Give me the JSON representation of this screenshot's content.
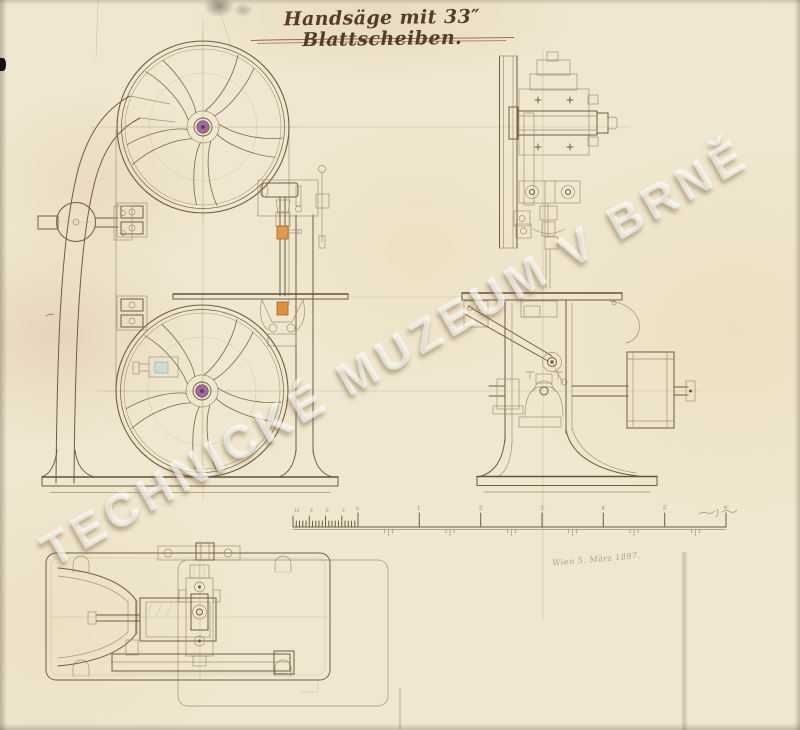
{
  "page": {
    "title": "Handsäge mit 33″ Blattscheiben.",
    "watermark": "TECHNICKÉ MUZEUM V BRNĚ",
    "date_note": "Wien 5. März 1897."
  },
  "scale_bar": {
    "zero_label": "0",
    "minor_labels": [
      "12",
      "9",
      "6",
      "3"
    ],
    "major_labels": [
      "1′",
      "2′",
      "3′",
      "4′",
      "5′",
      "6′"
    ]
  },
  "colors": {
    "paper": "#efe7cf",
    "ink": "#6f5c41",
    "ink_light": "#9b8a6d",
    "construction": "#b5a483",
    "accent_orange": "#dd9450",
    "accent_purple": "#a06b99",
    "title_ink": "#533d26",
    "underline_ink": "#8a4a2e",
    "watermark_white": "rgba(255,255,255,0.55)"
  }
}
